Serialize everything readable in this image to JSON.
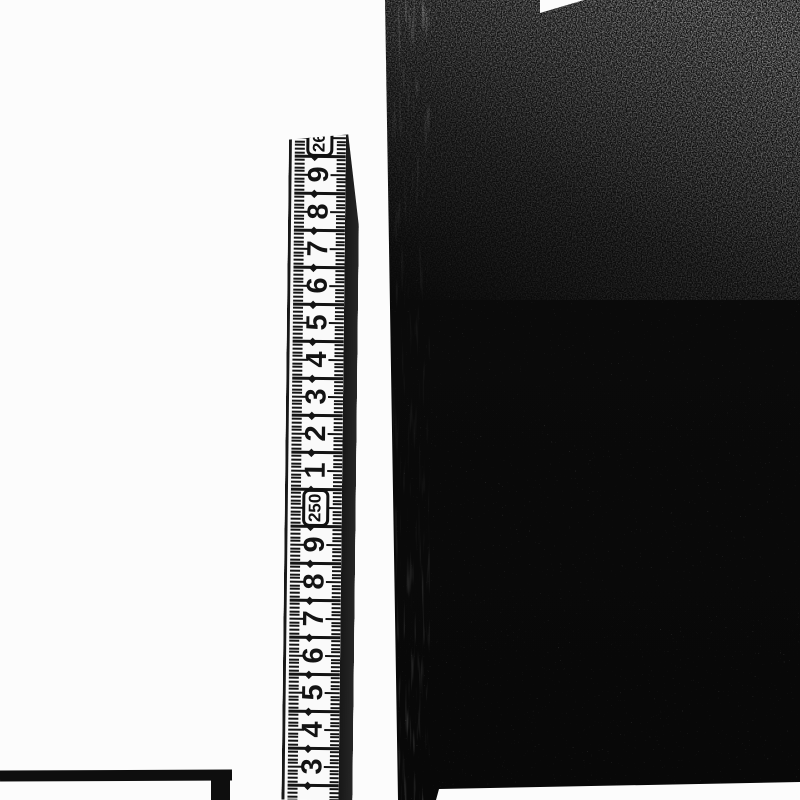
{
  "scene": {
    "background_color": "#fcfcfc",
    "ruler": {
      "unit": "cm",
      "orientation": "vertical",
      "top_px": 133,
      "bottom_px": 800,
      "left_px": 289,
      "white_width_px": 57,
      "edge_band_width_px": 14,
      "unit_step_px": 37,
      "first_label_center_px": 138,
      "tilt_deg": 0.65,
      "tick_color": "#141414",
      "tape_color": "#fafafa",
      "labels_top_to_bottom": [
        {
          "text": "260",
          "boxed": true
        },
        {
          "text": "9"
        },
        {
          "text": "8"
        },
        {
          "text": "7"
        },
        {
          "text": "6"
        },
        {
          "text": "5"
        },
        {
          "text": "4"
        },
        {
          "text": "3"
        },
        {
          "text": "2"
        },
        {
          "text": "1"
        },
        {
          "text": "250",
          "boxed": true
        },
        {
          "text": "9"
        },
        {
          "text": "8"
        },
        {
          "text": "7"
        },
        {
          "text": "6"
        },
        {
          "text": "5"
        },
        {
          "text": "4"
        },
        {
          "text": "3"
        }
      ]
    },
    "dark_object": {
      "base_color": "#0a0a0a",
      "grain_region": "top, fading down, brightest top-right",
      "left_edge_x_px": 385,
      "bottom_edge_y_px": 785
    },
    "frame_corner": {
      "color": "#0e0e0e",
      "bar_top_y_px": 770,
      "bar_right_x_px": 232
    }
  }
}
